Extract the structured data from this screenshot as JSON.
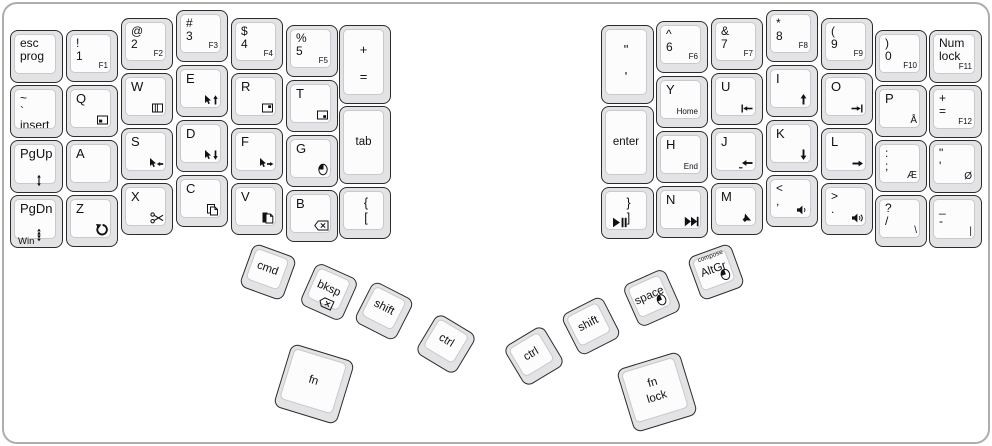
{
  "keyboard": {
    "type": "ergodox-split-keyboard-layout",
    "colors": {
      "key_skirt": "#e3e3e5",
      "key_face": "#fcfcfd",
      "key_border": "#2b2b2b",
      "frame": "#adadad",
      "legend": "#111111"
    }
  },
  "keys": [
    {
      "id": "esc",
      "x": 10,
      "y": 30,
      "w": 53,
      "h": 53,
      "lines": [
        "esc",
        "prog"
      ]
    },
    {
      "id": "tilde",
      "x": 10,
      "y": 85,
      "w": 53,
      "h": 53,
      "lines": [
        "~",
        "`",
        "insert"
      ]
    },
    {
      "id": "pgup",
      "x": 10,
      "y": 140,
      "w": 53,
      "h": 53,
      "lines": [
        "PgUp"
      ],
      "icon": "scroll-up",
      "icpos": "bc"
    },
    {
      "id": "pgdn",
      "x": 10,
      "y": 195,
      "w": 53,
      "h": 53,
      "lines": [
        "PgDn"
      ],
      "icon": "scroll-down",
      "icpos": "bc",
      "bl": "Win"
    },
    {
      "id": "1",
      "x": 66,
      "y": 30,
      "w": 52,
      "h": 52,
      "lines": [
        "!",
        "1"
      ],
      "br": "F1"
    },
    {
      "id": "q",
      "x": 66,
      "y": 85,
      "w": 52,
      "h": 52,
      "lines": [
        "Q"
      ],
      "icon": "window-bottomleft"
    },
    {
      "id": "a",
      "x": 66,
      "y": 140,
      "w": 52,
      "h": 52,
      "lines": [
        "A"
      ]
    },
    {
      "id": "z",
      "x": 66,
      "y": 195,
      "w": 52,
      "h": 52,
      "lines": [
        "Z"
      ],
      "icon": "undo"
    },
    {
      "id": "2",
      "x": 121,
      "y": 18,
      "w": 52,
      "h": 52,
      "lines": [
        "@",
        "2"
      ],
      "br": "F2"
    },
    {
      "id": "w",
      "x": 121,
      "y": 73,
      "w": 52,
      "h": 52,
      "lines": [
        "W"
      ],
      "icon": "window-panes"
    },
    {
      "id": "s",
      "x": 121,
      "y": 128,
      "w": 52,
      "h": 52,
      "lines": [
        "S"
      ],
      "icon": "mouse-cursor-left"
    },
    {
      "id": "x",
      "x": 121,
      "y": 183,
      "w": 52,
      "h": 52,
      "lines": [
        "X"
      ],
      "icon": "cut"
    },
    {
      "id": "3",
      "x": 176,
      "y": 10,
      "w": 52,
      "h": 52,
      "lines": [
        "#",
        "3"
      ],
      "br": "F3"
    },
    {
      "id": "e",
      "x": 176,
      "y": 65,
      "w": 52,
      "h": 52,
      "lines": [
        "E"
      ],
      "icon": "mouse-cursor-up"
    },
    {
      "id": "d",
      "x": 176,
      "y": 120,
      "w": 52,
      "h": 52,
      "lines": [
        "D"
      ],
      "icon": "mouse-cursor-down"
    },
    {
      "id": "c",
      "x": 176,
      "y": 175,
      "w": 52,
      "h": 52,
      "lines": [
        "C"
      ],
      "icon": "copy"
    },
    {
      "id": "4",
      "x": 231,
      "y": 18,
      "w": 52,
      "h": 52,
      "lines": [
        "$",
        "4"
      ],
      "br": "F4"
    },
    {
      "id": "r",
      "x": 231,
      "y": 73,
      "w": 52,
      "h": 52,
      "lines": [
        "R"
      ],
      "icon": "window-topright"
    },
    {
      "id": "f",
      "x": 231,
      "y": 128,
      "w": 52,
      "h": 52,
      "lines": [
        "F"
      ],
      "icon": "mouse-cursor-right"
    },
    {
      "id": "v",
      "x": 231,
      "y": 183,
      "w": 52,
      "h": 52,
      "lines": [
        "V"
      ],
      "icon": "paste"
    },
    {
      "id": "5",
      "x": 286,
      "y": 25,
      "w": 52,
      "h": 52,
      "lines": [
        "%",
        "5"
      ],
      "br": "F5"
    },
    {
      "id": "t",
      "x": 286,
      "y": 80,
      "w": 52,
      "h": 52,
      "lines": [
        "T"
      ],
      "icon": "window-bottomright"
    },
    {
      "id": "g",
      "x": 286,
      "y": 135,
      "w": 52,
      "h": 52,
      "lines": [
        "G"
      ],
      "icon": "mouse-button"
    },
    {
      "id": "b",
      "x": 286,
      "y": 190,
      "w": 52,
      "h": 52,
      "lines": [
        "B"
      ],
      "icon": "backspace"
    },
    {
      "id": "plus-equals",
      "x": 339,
      "y": 25,
      "w": 52,
      "h": 79,
      "lines": [
        "+",
        "="
      ],
      "cls": "tallc"
    },
    {
      "id": "tab",
      "x": 339,
      "y": 106,
      "w": 52,
      "h": 78,
      "lines": [
        "tab"
      ],
      "center": true
    },
    {
      "id": "lbracket",
      "x": 339,
      "y": 187,
      "w": 52,
      "h": 52,
      "lines": [
        "{",
        "["
      ],
      "cls": "symc"
    },
    {
      "id": "quote-tall",
      "x": 601,
      "y": 25,
      "w": 53,
      "h": 79,
      "lines": [
        "\"",
        "'"
      ],
      "cls": "tallc"
    },
    {
      "id": "enter",
      "x": 601,
      "y": 106,
      "w": 53,
      "h": 78,
      "lines": [
        "enter"
      ],
      "center": true
    },
    {
      "id": "rbracket",
      "x": 601,
      "y": 187,
      "w": 53,
      "h": 52,
      "lines": [
        "}",
        "]"
      ],
      "cls": "symc",
      "icon": "play-pause",
      "icpos": "bl"
    },
    {
      "id": "6",
      "x": 656,
      "y": 21,
      "w": 52,
      "h": 52,
      "lines": [
        "^",
        "6"
      ],
      "br": "F6"
    },
    {
      "id": "y",
      "x": 656,
      "y": 76,
      "w": 52,
      "h": 52,
      "lines": [
        "Y"
      ],
      "br": "Home"
    },
    {
      "id": "h",
      "x": 656,
      "y": 131,
      "w": 52,
      "h": 52,
      "lines": [
        "H"
      ],
      "br": "End"
    },
    {
      "id": "n",
      "x": 656,
      "y": 186,
      "w": 52,
      "h": 52,
      "lines": [
        "N"
      ],
      "icon": "next-track"
    },
    {
      "id": "7",
      "x": 711,
      "y": 18,
      "w": 52,
      "h": 52,
      "lines": [
        "&",
        "7"
      ],
      "br": "F7"
    },
    {
      "id": "u",
      "x": 711,
      "y": 73,
      "w": 52,
      "h": 52,
      "lines": [
        "U"
      ],
      "icon": "line-start"
    },
    {
      "id": "j",
      "x": 711,
      "y": 128,
      "w": 52,
      "h": 52,
      "lines": [
        "J"
      ],
      "icon": "arrow-left"
    },
    {
      "id": "m",
      "x": 711,
      "y": 183,
      "w": 52,
      "h": 52,
      "lines": [
        "M"
      ],
      "icon": "mute"
    },
    {
      "id": "8",
      "x": 766,
      "y": 10,
      "w": 52,
      "h": 52,
      "lines": [
        "*",
        "8"
      ],
      "br": "F8"
    },
    {
      "id": "i",
      "x": 766,
      "y": 65,
      "w": 52,
      "h": 52,
      "lines": [
        "I"
      ],
      "icon": "arrow-up"
    },
    {
      "id": "k",
      "x": 766,
      "y": 120,
      "w": 52,
      "h": 52,
      "lines": [
        "K"
      ],
      "icon": "arrow-down"
    },
    {
      "id": "comma",
      "x": 766,
      "y": 175,
      "w": 52,
      "h": 52,
      "lines": [
        "<",
        ","
      ],
      "icon": "volume-down"
    },
    {
      "id": "9",
      "x": 821,
      "y": 18,
      "w": 52,
      "h": 52,
      "lines": [
        "(",
        "9"
      ],
      "br": "F9"
    },
    {
      "id": "o",
      "x": 821,
      "y": 73,
      "w": 52,
      "h": 52,
      "lines": [
        "O"
      ],
      "icon": "line-end"
    },
    {
      "id": "l",
      "x": 821,
      "y": 128,
      "w": 52,
      "h": 52,
      "lines": [
        "L"
      ],
      "icon": "arrow-right"
    },
    {
      "id": "period",
      "x": 821,
      "y": 183,
      "w": 52,
      "h": 52,
      "lines": [
        ">",
        "."
      ],
      "icon": "volume-up"
    },
    {
      "id": "0",
      "x": 875,
      "y": 30,
      "w": 52,
      "h": 52,
      "lines": [
        ")",
        "0"
      ],
      "br": "F10"
    },
    {
      "id": "p",
      "x": 875,
      "y": 85,
      "w": 52,
      "h": 52,
      "lines": [
        "P"
      ],
      "br": "Å"
    },
    {
      "id": "semicolon",
      "x": 875,
      "y": 140,
      "w": 52,
      "h": 52,
      "lines": [
        ":",
        ";"
      ],
      "br": "Æ"
    },
    {
      "id": "slash",
      "x": 875,
      "y": 195,
      "w": 52,
      "h": 52,
      "lines": [
        "?",
        "/"
      ],
      "br": "\\"
    },
    {
      "id": "numlock",
      "x": 929,
      "y": 30,
      "w": 53,
      "h": 53,
      "lines": [
        "Num",
        "lock"
      ],
      "br": "F11"
    },
    {
      "id": "f12",
      "x": 929,
      "y": 85,
      "w": 53,
      "h": 53,
      "lines": [
        "+",
        "="
      ],
      "br": "F12"
    },
    {
      "id": "quote",
      "x": 929,
      "y": 140,
      "w": 53,
      "h": 53,
      "lines": [
        "\"",
        "'"
      ],
      "br": "Ø"
    },
    {
      "id": "dash",
      "x": 929,
      "y": 195,
      "w": 53,
      "h": 53,
      "lines": [
        "_",
        "-"
      ],
      "br": "|"
    },
    {
      "id": "cmd",
      "x": 245,
      "y": 249,
      "w": 46,
      "h": 46,
      "rot": 20,
      "lines": [
        "cmd"
      ],
      "center": true
    },
    {
      "id": "bksp",
      "x": 306,
      "y": 269,
      "w": 46,
      "h": 46,
      "rot": 24,
      "lines": [
        "bksp"
      ],
      "center": true,
      "icon": "backspace",
      "icpos": "bc"
    },
    {
      "id": "shift-left",
      "x": 361,
      "y": 288,
      "w": 46,
      "h": 46,
      "rot": 27,
      "lines": [
        "shift"
      ],
      "center": true
    },
    {
      "id": "ctrl-left",
      "x": 423,
      "y": 321,
      "w": 46,
      "h": 46,
      "rot": 31,
      "lines": [
        "ctrl"
      ],
      "center": true
    },
    {
      "id": "fn-left",
      "x": 281,
      "y": 351,
      "w": 66,
      "h": 66,
      "rot": 17,
      "lines": [
        "fn"
      ],
      "center": true
    },
    {
      "id": "ctrl-right",
      "x": 511,
      "y": 333,
      "w": 46,
      "h": 46,
      "rot": -31,
      "lines": [
        "ctrl"
      ],
      "center": true
    },
    {
      "id": "shift-right",
      "x": 568,
      "y": 303,
      "w": 46,
      "h": 46,
      "rot": -27,
      "lines": [
        "shift"
      ],
      "center": true
    },
    {
      "id": "space",
      "x": 629,
      "y": 275,
      "w": 46,
      "h": 46,
      "rot": -24,
      "lines": [
        "space"
      ],
      "center": true,
      "icon": "mouse-button",
      "icpos": "br"
    },
    {
      "id": "altgr",
      "x": 693,
      "y": 249,
      "w": 46,
      "h": 46,
      "rot": -20,
      "lines": [
        "AltGr"
      ],
      "center": true,
      "tc": "compose",
      "icon": "mouse-button",
      "icpos": "br"
    },
    {
      "id": "fn-lock",
      "x": 624,
      "y": 359,
      "w": 66,
      "h": 66,
      "rot": -17,
      "lines": [
        "fn",
        "lock"
      ],
      "center": true
    }
  ]
}
